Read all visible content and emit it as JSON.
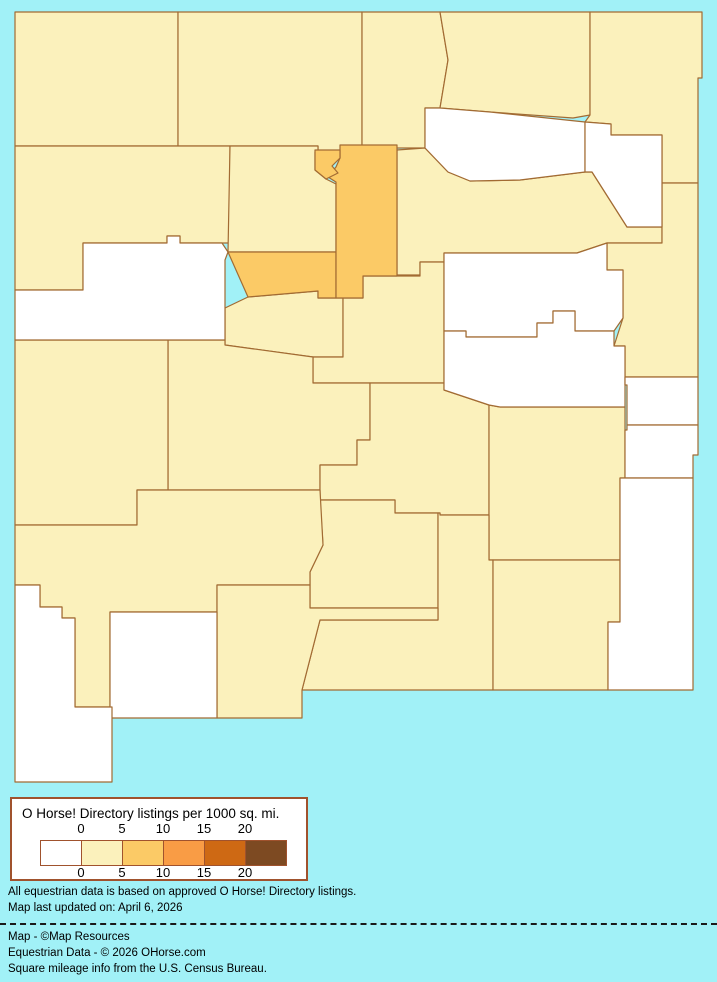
{
  "page": {
    "background_color": "#A1F1F7",
    "border_color": "#A26B33"
  },
  "legend": {
    "title": "O Horse! Directory listings per 1000 sq. mi.",
    "ticks": [
      "0",
      "5",
      "10",
      "15",
      "20"
    ],
    "colors": [
      "#FFFFFF",
      "#FBF1BC",
      "#FBCA66",
      "#F99C45",
      "#CE6914",
      "#7D4A22"
    ]
  },
  "notes": {
    "line1": "All equestrian data is based on approved O Horse! Directory listings.",
    "line2": "Map last updated on: April 6, 2026",
    "credit1": "Map - ©Map Resources",
    "credit2": "Equestrian Data - © 2026 OHorse.com",
    "credit3": "Square mileage info from the U.S. Census Bureau."
  },
  "map_data": {
    "type": "choropleth",
    "region": "New Mexico counties",
    "class_colors": {
      "0": "#FFFFFF",
      "0-5": "#FBF1BC",
      "5-10": "#FBCA66"
    },
    "counties": [
      {
        "id": "san-juan",
        "listings_class": "0-5",
        "points": "15,12 178,12 178,146 15,146"
      },
      {
        "id": "rio-arriba",
        "listings_class": "0-5",
        "points": "178,12 362,12 362,148 345,148 345,152 318,152 318,146 178,146"
      },
      {
        "id": "taos",
        "listings_class": "0-5",
        "points": "362,12 440,12 448,60 440,108 425,108 425,148 362,148"
      },
      {
        "id": "colfax",
        "listings_class": "0-5",
        "points": "440,12 590,12 590,115 573,118 490,112 440,108 448,60"
      },
      {
        "id": "union",
        "listings_class": "0-5",
        "points": "590,12 702,12 702,78 698,78 698,183 662,183 662,135 611,135 611,124 585,122 590,115"
      },
      {
        "id": "mckinley",
        "listings_class": "0-5",
        "points": "15,146 230,146 230,243 180,243 180,236 167,236 167,243 83,243 83,290 15,290"
      },
      {
        "id": "sandoval",
        "listings_class": "0-5",
        "points": "230,146 318,146 318,152 315,152 315,170 326,179 336,184 336,252 228,252"
      },
      {
        "id": "san-miguel",
        "listings_class": "0-5",
        "points": "397,150 425,148 448,172 470,181 520,180 585,172 592,172 627,227 662,227 662,243 607,243 577,253 444,253 444,262 420,262 420,275 397,275"
      },
      {
        "id": "quay",
        "listings_class": "0-5",
        "points": "662,183 698,183 698,377 625,377 625,346 614,346 623,318 623,270 607,270 607,243 662,243"
      },
      {
        "id": "valencia",
        "listings_class": "0-5",
        "points": "248,297 318,291 318,298 343,298 343,357 313,357 225,345 225,308"
      },
      {
        "id": "torrance",
        "listings_class": "0-5",
        "points": "343,298 363,298 363,276 420,276 420,262 444,262 444,383 313,383 313,357 343,357"
      },
      {
        "id": "socorro",
        "listings_class": "0-5",
        "points": "168,340 225,340 225,345 313,357 313,383 370,383 370,440 357,440 357,465 320,465 320,490 168,490"
      },
      {
        "id": "lincoln",
        "listings_class": "0-5",
        "points": "370,383 444,383 444,390 489,405 489,515 440,515 440,513 395,513 395,500 320,500 320,465 357,465 357,440 370,440"
      },
      {
        "id": "catron",
        "listings_class": "0-5",
        "points": "15,340 168,340 168,490 137,490 137,525 15,525"
      },
      {
        "id": "chaves",
        "listings_class": "0-5",
        "points": "489,405 500,407 625,407 625,478 620,478 620,560 489,560"
      },
      {
        "id": "sierra",
        "listings_class": "0-5",
        "points": "320,500 395,500 395,513 438,513 438,608 310,608 310,572 323,545"
      },
      {
        "id": "otero",
        "listings_class": "0-5",
        "points": "438,513 440,513 440,515 489,515 489,560 493,560 493,690 302,690 320,620 438,620"
      },
      {
        "id": "grant",
        "listings_class": "0-5",
        "points": "15,525 137,525 137,490 320,490 323,545 310,572 310,585 217,585 217,612 110,612 110,707 75,707 75,618 62,618 62,607 40,607 40,585 15,585"
      },
      {
        "id": "dona-ana",
        "listings_class": "0-5",
        "points": "217,585 310,585 310,608 438,608 438,620 320,620 302,690 302,718 217,718"
      },
      {
        "id": "eddy",
        "listings_class": "0-5",
        "points": "493,560 620,560 620,622 608,622 608,690 493,690"
      },
      {
        "id": "mora",
        "listings_class": "0",
        "points": "425,108 440,108 490,112 585,122 585,172 520,180 470,181 448,172 425,148"
      },
      {
        "id": "harding",
        "listings_class": "0",
        "points": "585,122 611,124 611,135 662,135 662,227 627,227 592,172 585,172"
      },
      {
        "id": "cibola",
        "listings_class": "0",
        "points": "83,243 167,243 167,236 180,236 180,243 222,243 228,252 225,260 225,340 15,340 15,290 83,290"
      },
      {
        "id": "guadalupe",
        "listings_class": "0",
        "points": "444,253 577,253 607,243 607,270 623,270 623,318 614,331 575,331 575,311 553,311 553,323 537,323 537,337 466,337 466,331 444,331"
      },
      {
        "id": "de-baca",
        "listings_class": "0",
        "points": "444,331 466,331 466,337 537,337 537,323 553,323 553,311 575,311 575,331 614,331 614,346 625,346 625,407 500,407 489,405 444,390"
      },
      {
        "id": "curry",
        "listings_class": "0",
        "points": "625,377 698,377 698,425 627,425 627,385 625,385"
      },
      {
        "id": "roosevelt",
        "listings_class": "0",
        "points": "627,425 698,425 698,455 693,455 693,478 625,478 625,430 627,430"
      },
      {
        "id": "lea",
        "listings_class": "0",
        "points": "620,478 693,478 693,690 608,690 608,622 620,622"
      },
      {
        "id": "luna",
        "listings_class": "0",
        "points": "110,612 217,612 217,718 110,718"
      },
      {
        "id": "hidalgo",
        "listings_class": "0",
        "points": "15,585 40,585 40,607 62,607 62,618 75,618 75,707 112,707 112,782 15,782"
      },
      {
        "id": "bernalillo",
        "listings_class": "5-10",
        "points": "228,252 336,252 336,298 318,298 318,291 248,297"
      },
      {
        "id": "santa-fe",
        "listings_class": "5-10",
        "points": "340,145 397,145 397,276 363,276 363,298 336,298 336,182 328,177 336,167 340,158"
      },
      {
        "id": "los-alamos",
        "listings_class": "5-10",
        "points": "315,150 340,150 340,158 332,166 338,173 326,179 315,170"
      }
    ]
  }
}
